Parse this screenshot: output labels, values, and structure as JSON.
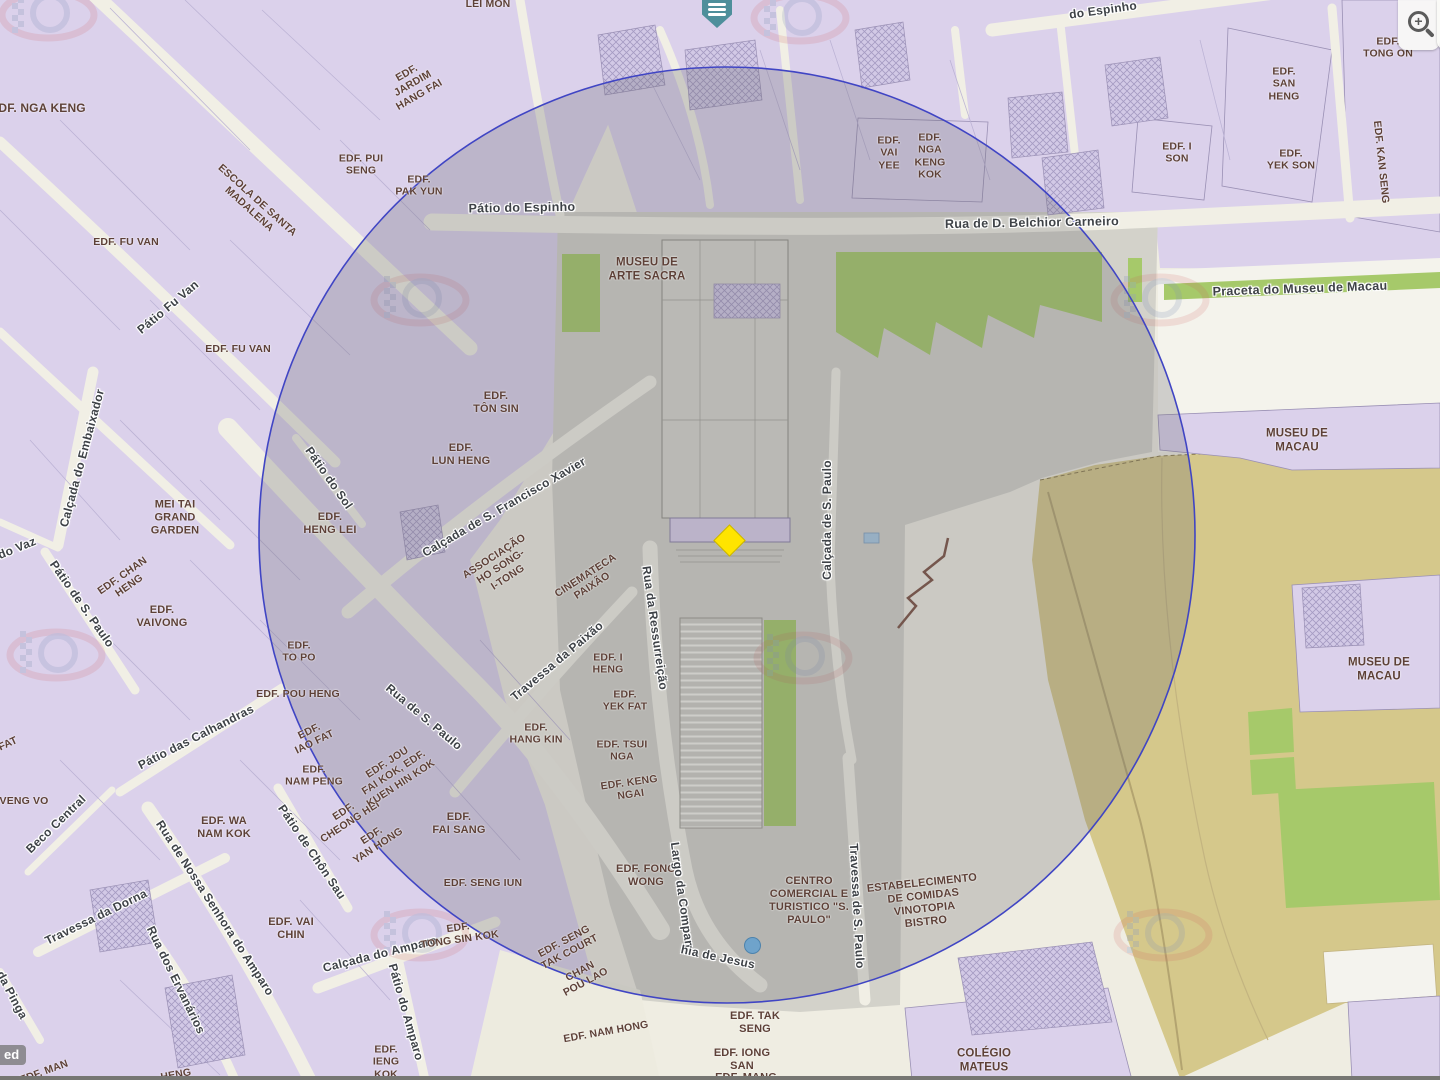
{
  "colors": {
    "street_background": "#EFEDE2",
    "building_fill": "#DBD1EB",
    "plaza_fill": "#D3D2CA",
    "fortress_fill": "#D5C88B",
    "green_fill": "#A6C96A",
    "radius_circle_stroke": "#4045C4",
    "selected_marker_yellow": "#FFE400",
    "poi_pin_teal": "#4E8F9B",
    "building_label": "#5D4037",
    "street_label": "#3E4247"
  },
  "icons": {
    "zoom_in": "magnifier-plus-icon",
    "zoom_out_partial": "magnifier-icon",
    "poi_pin": "menu-pin-icon",
    "selected_marker": "yellow-diamond-icon",
    "poi_dot": "blue-dot-icon",
    "watermark": "cartography-watermark"
  },
  "attribution_partial": "ed",
  "labels": [
    {
      "t": "LEI MON",
      "x": 488,
      "y": 4,
      "r": 0,
      "k": "b"
    },
    {
      "t": "EDF. NGA KENG",
      "x": 38,
      "y": 108,
      "r": 0,
      "k": "b",
      "s": 12
    },
    {
      "t": "EDF.\nJARDIM\nHANG FAI",
      "x": 413,
      "y": 84,
      "r": -30,
      "k": "b"
    },
    {
      "t": "EDF. PUI\nSENG",
      "x": 361,
      "y": 165,
      "r": 0,
      "k": "b"
    },
    {
      "t": "EDF.\nPAK YUN",
      "x": 419,
      "y": 186,
      "r": 0,
      "k": "b"
    },
    {
      "t": "ESCOLA DE SANTA\nMADALENA",
      "x": 253,
      "y": 205,
      "r": 42,
      "k": "b"
    },
    {
      "t": "EDF. FU VAN",
      "x": 126,
      "y": 242,
      "r": 0,
      "k": "b"
    },
    {
      "t": "Pátio Fu Van",
      "x": 168,
      "y": 307,
      "r": -40,
      "k": "s"
    },
    {
      "t": "EDF. FU VAN",
      "x": 238,
      "y": 349,
      "r": 0,
      "k": "b"
    },
    {
      "t": "Pátio do Espinho",
      "x": 522,
      "y": 208,
      "r": -1,
      "k": "s",
      "s": 12.5
    },
    {
      "t": "MUSEU DE\nARTE SACRA",
      "x": 647,
      "y": 270,
      "r": 0,
      "k": "b",
      "s": 11.5
    },
    {
      "t": "EDF.\nVAI\nYEE",
      "x": 889,
      "y": 153,
      "r": 0,
      "k": "b"
    },
    {
      "t": "EDF.\nNGA\nKENG\nKOK",
      "x": 930,
      "y": 156,
      "r": 0,
      "k": "b"
    },
    {
      "t": "Rua de D. Belchior Carneiro",
      "x": 1032,
      "y": 223,
      "r": -1,
      "k": "s",
      "s": 12.5
    },
    {
      "t": "do Espinho",
      "x": 1103,
      "y": 10,
      "r": -8,
      "k": "s"
    },
    {
      "t": "EDF. I\nSON",
      "x": 1177,
      "y": 153,
      "r": 0,
      "k": "b"
    },
    {
      "t": "EDF.\nSAN\nHENG",
      "x": 1284,
      "y": 84,
      "r": 0,
      "k": "b"
    },
    {
      "t": "EDF.\nYEK SON",
      "x": 1291,
      "y": 160,
      "r": 0,
      "k": "b"
    },
    {
      "t": "EDF.\nTONG ON",
      "x": 1388,
      "y": 48,
      "r": 0,
      "k": "b"
    },
    {
      "t": "EDF. KAN SENG",
      "x": 1381,
      "y": 162,
      "r": 84,
      "k": "b"
    },
    {
      "t": "Praceta do Museu de Macau",
      "x": 1300,
      "y": 289,
      "r": -2,
      "k": "s",
      "s": 12.5
    },
    {
      "t": "MUSEU DE\nMACAU",
      "x": 1297,
      "y": 441,
      "r": 0,
      "k": "b",
      "s": 11.5
    },
    {
      "t": "MUSEU DE\nMACAU",
      "x": 1379,
      "y": 670,
      "r": 0,
      "k": "b",
      "s": 11.5
    },
    {
      "t": "Calçada do Embaixador",
      "x": 82,
      "y": 458,
      "r": -75,
      "k": "s"
    },
    {
      "t": "do Vaz",
      "x": 17,
      "y": 548,
      "r": -22,
      "k": "s"
    },
    {
      "t": "Pátio de S. Paulo",
      "x": 82,
      "y": 604,
      "r": 55,
      "k": "s"
    },
    {
      "t": "MEI TAI\nGRAND\nGARDEN",
      "x": 175,
      "y": 518,
      "r": 0,
      "k": "b",
      "s": 11
    },
    {
      "t": "EDF. CHAN\nHENG",
      "x": 126,
      "y": 581,
      "r": -35,
      "k": "b"
    },
    {
      "t": "EDF.\nVAIVONG",
      "x": 162,
      "y": 617,
      "r": 0,
      "k": "b",
      "s": 11
    },
    {
      "t": "Pátio do Sol",
      "x": 329,
      "y": 478,
      "r": 55,
      "k": "s"
    },
    {
      "t": "EDF.\nHENG LEI",
      "x": 330,
      "y": 524,
      "r": 0,
      "k": "b",
      "s": 11
    },
    {
      "t": "EDF.\nTÔN SIN",
      "x": 496,
      "y": 403,
      "r": 0,
      "k": "b",
      "s": 11
    },
    {
      "t": "EDF.\nLUN HENG",
      "x": 461,
      "y": 455,
      "r": 0,
      "k": "b",
      "s": 11
    },
    {
      "t": "Calçada de S. Francisco Xavier",
      "x": 504,
      "y": 507,
      "r": -30,
      "k": "s"
    },
    {
      "t": "ASSOCIAÇÃO\nHO SONG-\nI-TONG",
      "x": 501,
      "y": 567,
      "r": -33,
      "k": "b"
    },
    {
      "t": "CINEMATECA\nPAIXÃO",
      "x": 589,
      "y": 581,
      "r": -33,
      "k": "b"
    },
    {
      "t": "EDF.\nTO PO",
      "x": 299,
      "y": 652,
      "r": 0,
      "k": "b"
    },
    {
      "t": "EDF. POU HENG",
      "x": 298,
      "y": 694,
      "r": 0,
      "k": "b"
    },
    {
      "t": "Travessa da Paixão",
      "x": 557,
      "y": 661,
      "r": -40,
      "k": "s"
    },
    {
      "t": "Rua da Ressurreição",
      "x": 655,
      "y": 628,
      "r": 82,
      "k": "s"
    },
    {
      "t": "Rua de S. Paulo",
      "x": 424,
      "y": 717,
      "r": 40,
      "k": "s"
    },
    {
      "t": "EDF. I\nHENG",
      "x": 608,
      "y": 664,
      "r": 0,
      "k": "b"
    },
    {
      "t": "EDF.\nYEK FAT",
      "x": 625,
      "y": 701,
      "r": 0,
      "k": "b"
    },
    {
      "t": "EDF.\nHANG KIN",
      "x": 536,
      "y": 734,
      "r": 0,
      "k": "b"
    },
    {
      "t": "EDF. TSUI\nNGA",
      "x": 622,
      "y": 751,
      "r": 0,
      "k": "b"
    },
    {
      "t": "EDF. KENG\nNGAI",
      "x": 630,
      "y": 789,
      "r": -8,
      "k": "b"
    },
    {
      "t": "EDF.\nIAO FAT",
      "x": 312,
      "y": 737,
      "r": -26,
      "k": "b"
    },
    {
      "t": "EDF.\nNAM PENG",
      "x": 314,
      "y": 776,
      "r": 0,
      "k": "b"
    },
    {
      "t": "EDF.\nCHEONG HEI",
      "x": 347,
      "y": 817,
      "r": -33,
      "k": "b"
    },
    {
      "t": "EDF.\nYAN HONG",
      "x": 375,
      "y": 841,
      "r": -33,
      "k": "b"
    },
    {
      "t": "EDF. JOU\nFAI KOK, EDF.\nKUEN HIN KOK",
      "x": 394,
      "y": 773,
      "r": -33,
      "k": "b"
    },
    {
      "t": "Pátio das Calhandras",
      "x": 196,
      "y": 737,
      "r": -27,
      "k": "s"
    },
    {
      "t": "Beco Central",
      "x": 56,
      "y": 824,
      "r": -44,
      "k": "s"
    },
    {
      "t": "VENG VO",
      "x": 24,
      "y": 801,
      "r": 0,
      "k": "b"
    },
    {
      "t": "FAT",
      "x": 8,
      "y": 744,
      "r": -25,
      "k": "b"
    },
    {
      "t": "EDF. WA\nNAM KOK",
      "x": 224,
      "y": 828,
      "r": 0,
      "k": "b",
      "s": 11
    },
    {
      "t": "Travessa da Dorna",
      "x": 96,
      "y": 917,
      "r": -26,
      "k": "s"
    },
    {
      "t": "Rua de Nossa Senhora do Amparo",
      "x": 215,
      "y": 908,
      "r": 57,
      "k": "s"
    },
    {
      "t": "Rua dos Ervanários",
      "x": 176,
      "y": 980,
      "r": 64,
      "k": "s"
    },
    {
      "t": "Pátio de Chôn Sau",
      "x": 312,
      "y": 852,
      "r": 56,
      "k": "s"
    },
    {
      "t": "EDF. VAI\nCHIN",
      "x": 291,
      "y": 929,
      "r": 0,
      "k": "b",
      "s": 11
    },
    {
      "t": "EDF.\nFAI SANG",
      "x": 459,
      "y": 824,
      "r": 0,
      "k": "b",
      "s": 11
    },
    {
      "t": "EDF. SENG IUN",
      "x": 483,
      "y": 883,
      "r": 0,
      "k": "b"
    },
    {
      "t": "Calçada do Amparo",
      "x": 380,
      "y": 954,
      "r": -14,
      "k": "s"
    },
    {
      "t": "EDF.\nTONG SIN KOK",
      "x": 459,
      "y": 934,
      "r": -8,
      "k": "b"
    },
    {
      "t": "Pátio do Amparo",
      "x": 406,
      "y": 1012,
      "r": 74,
      "k": "s"
    },
    {
      "t": "da Pinga",
      "x": 12,
      "y": 995,
      "r": 62,
      "k": "s"
    },
    {
      "t": "EDF. MAN",
      "x": 44,
      "y": 1072,
      "r": -20,
      "k": "b"
    },
    {
      "t": "HENG",
      "x": 176,
      "y": 1075,
      "r": -10,
      "k": "b"
    },
    {
      "t": "EDF. SENG\nTAK COURT",
      "x": 567,
      "y": 947,
      "r": -28,
      "k": "b"
    },
    {
      "t": "CHAN\nPOU LAO",
      "x": 583,
      "y": 977,
      "r": -28,
      "k": "b"
    },
    {
      "t": "EDF. NAM HONG",
      "x": 606,
      "y": 1032,
      "r": -10,
      "k": "b"
    },
    {
      "t": "EDF. FONG\nWONG",
      "x": 646,
      "y": 876,
      "r": 0,
      "k": "b",
      "s": 11
    },
    {
      "t": "Largo da Compan",
      "x": 682,
      "y": 895,
      "r": 82,
      "k": "s"
    },
    {
      "t": "hia de Jesus",
      "x": 718,
      "y": 957,
      "r": 12,
      "k": "s"
    },
    {
      "t": "Travessa de S. Paulo",
      "x": 857,
      "y": 906,
      "r": 87,
      "k": "s"
    },
    {
      "t": "Calçada de S. Paulo",
      "x": 827,
      "y": 520,
      "r": -90,
      "k": "s"
    },
    {
      "t": "CENTRO\nCOMERCIAL E\nTURISTICO \"S.\nPAULO\"",
      "x": 809,
      "y": 901,
      "r": 0,
      "k": "b",
      "s": 11
    },
    {
      "t": "ESTABELECIMENTO\nDE COMIDAS\nVINOTOPIA\nBISTRO",
      "x": 924,
      "y": 903,
      "r": -6,
      "k": "b",
      "s": 11
    },
    {
      "t": "EDF. TAK\nSENG",
      "x": 755,
      "y": 1023,
      "r": 0,
      "k": "b",
      "s": 11
    },
    {
      "t": "EDF. IONG\nSAN",
      "x": 742,
      "y": 1060,
      "r": 0,
      "k": "b",
      "s": 11
    },
    {
      "t": "EDF. MANG",
      "x": 746,
      "y": 1078,
      "r": 0,
      "k": "b",
      "s": 11
    },
    {
      "t": "COLÉGIO\nMATEUS",
      "x": 984,
      "y": 1061,
      "r": 0,
      "k": "b",
      "s": 11.5
    },
    {
      "t": "EDF.\nIENG\nKOK",
      "x": 386,
      "y": 1062,
      "r": 0,
      "k": "b"
    }
  ]
}
